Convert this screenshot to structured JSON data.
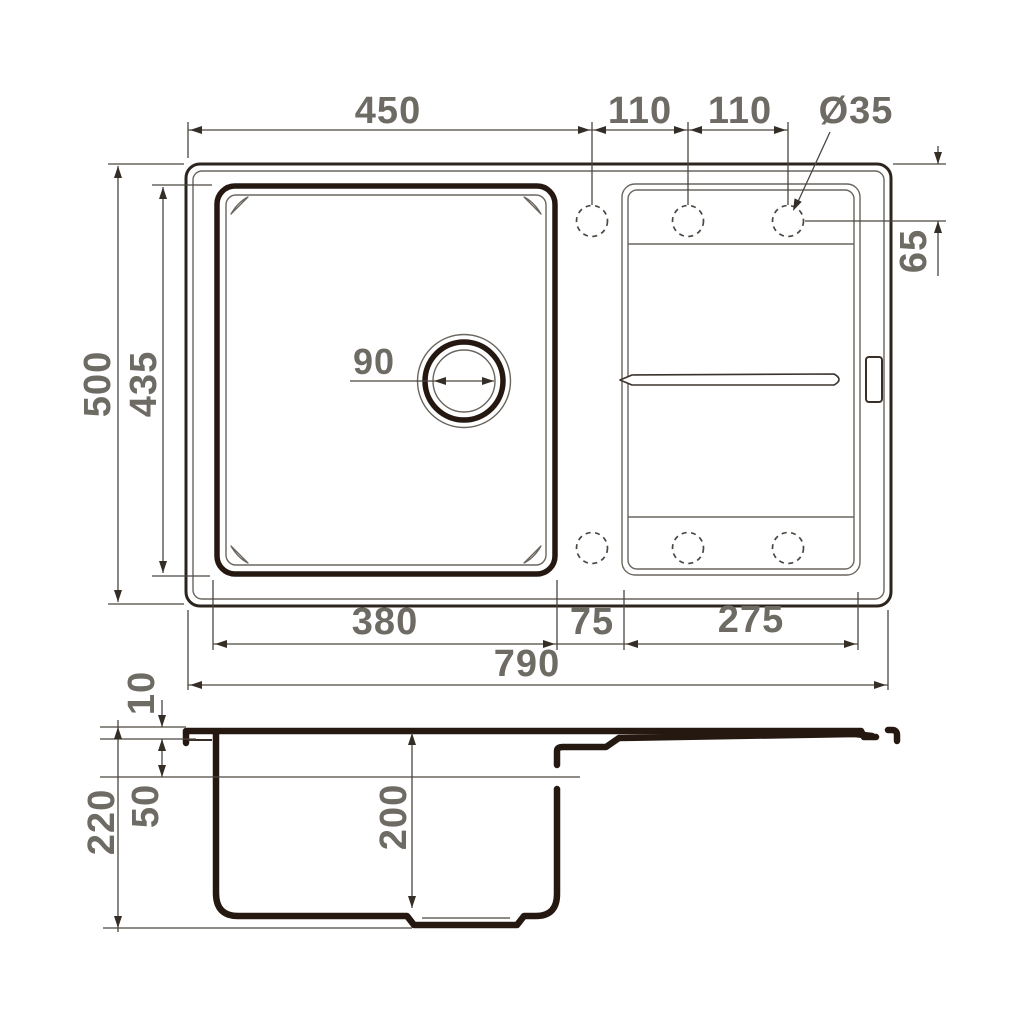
{
  "drawing_title": "Kitchen sink dimensional drawing",
  "views": {
    "top": {
      "labels": {
        "bowl_outer_width": "450",
        "hole_pitch_left": "110",
        "hole_pitch_right": "110",
        "faucet_hole_dia": "Ø35",
        "overall_depth": "500",
        "bowl_length": "435",
        "hole_edge_offset": "65",
        "drain_dia": "90",
        "bowl_width": "380",
        "mid_gap": "75",
        "drainboard_width": "275",
        "overall_width": "790"
      }
    },
    "side": {
      "labels": {
        "rim_thickness": "10",
        "overflow_level": "50",
        "overall_height": "220",
        "bowl_inner_depth": "200"
      }
    }
  },
  "colors": {
    "section_line": "#241811",
    "outline_line": "#2d241d",
    "thin_line": "#6a655e",
    "dimension_line": "#4c463f",
    "label_text": "#6e6a64",
    "background": "#ffffff"
  }
}
